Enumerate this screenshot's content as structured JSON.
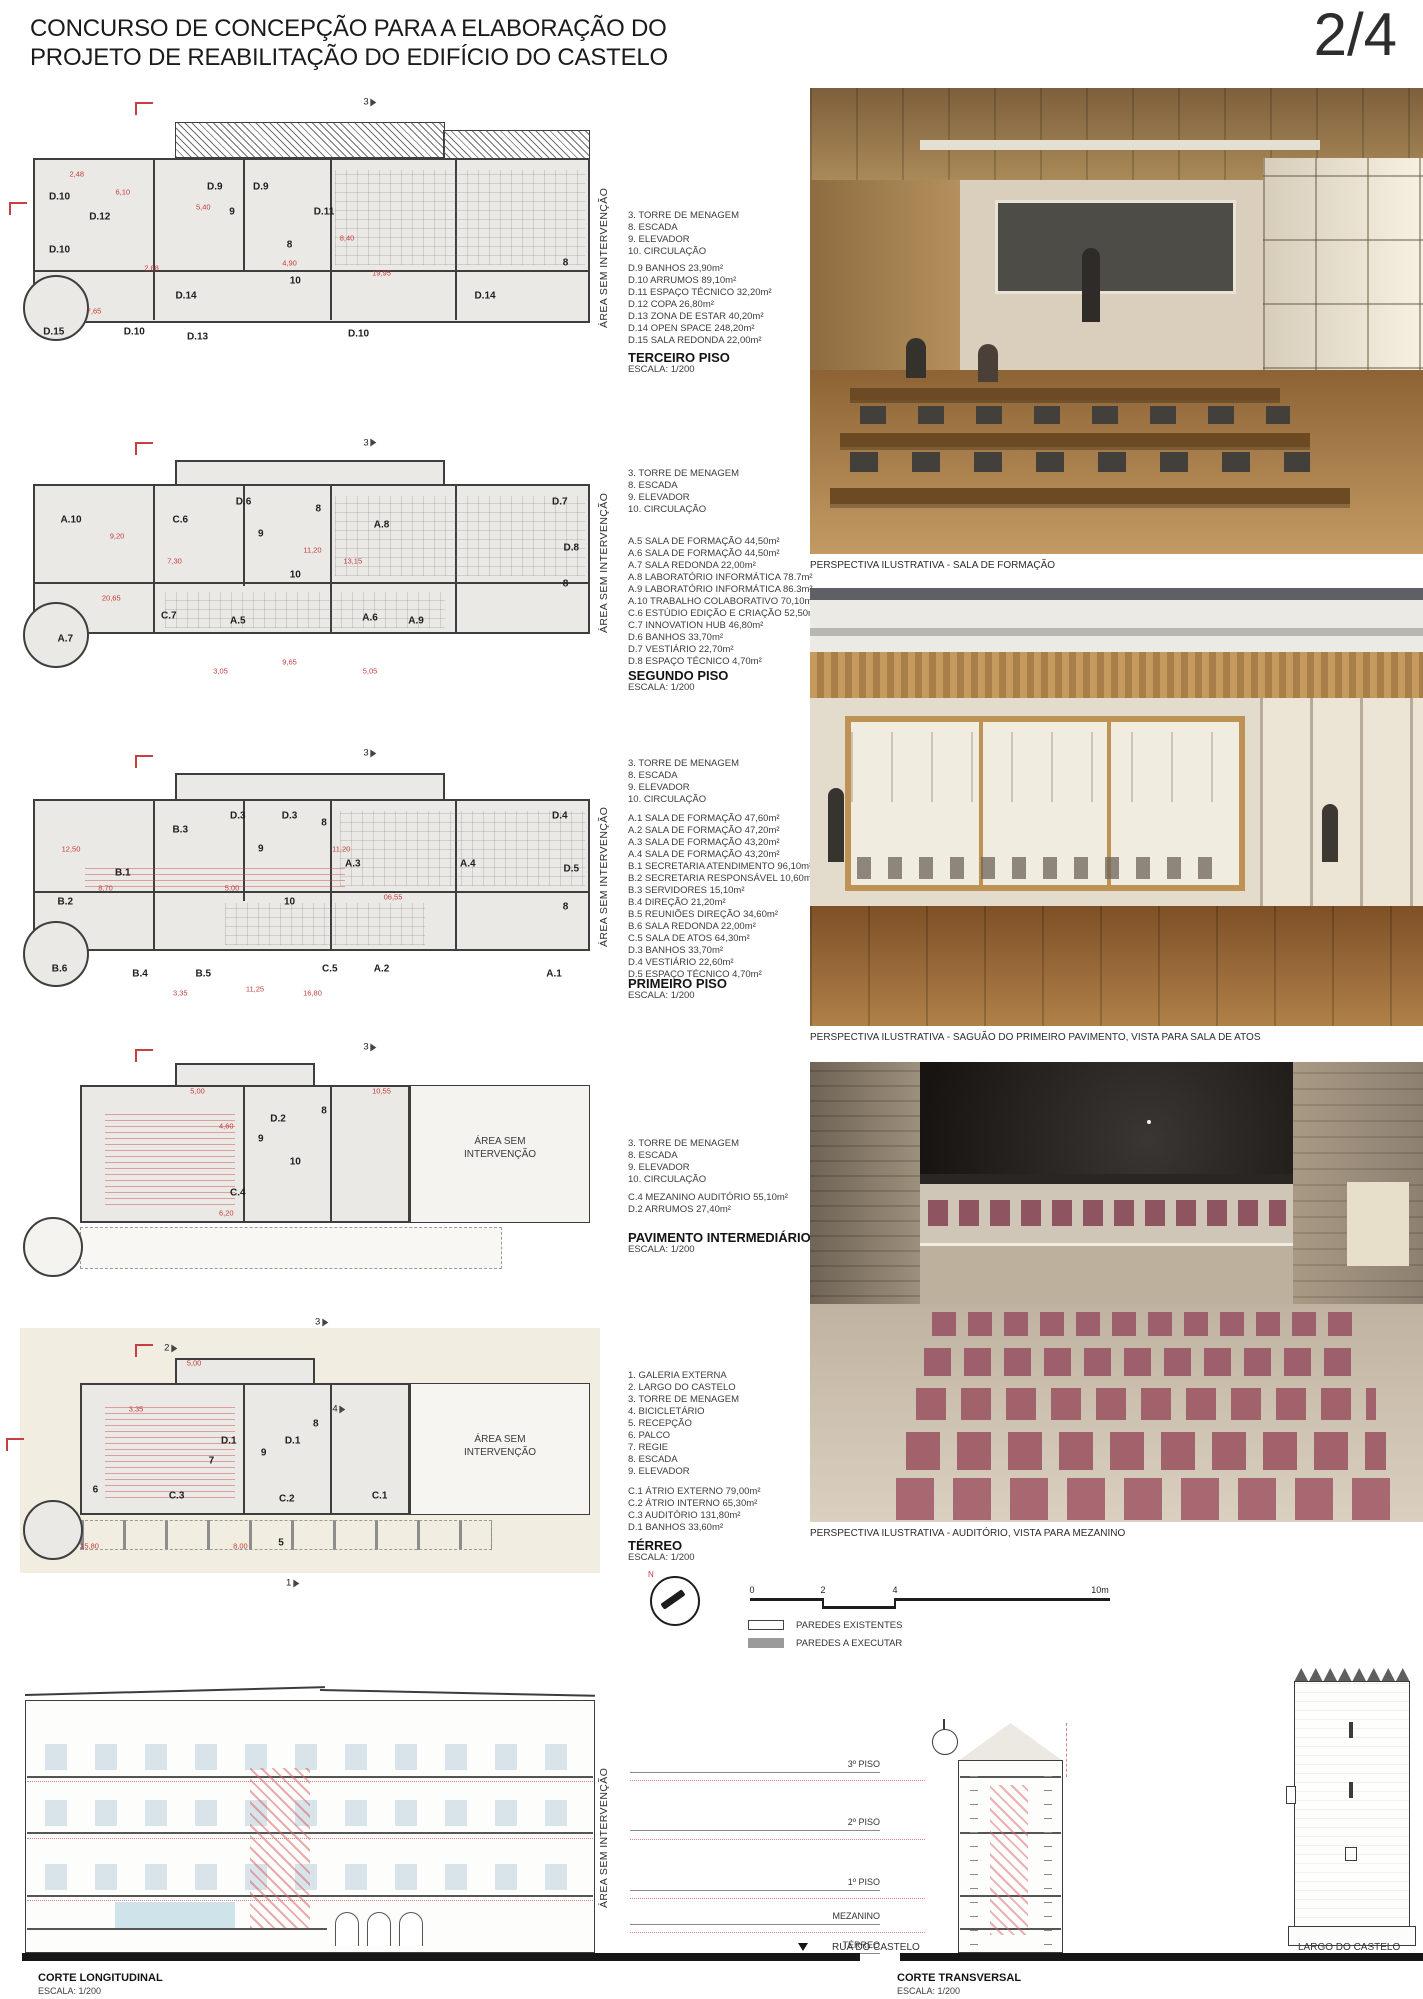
{
  "header": {
    "title_line1": "CONCURSO DE CONCEPÇÃO PARA A ELABORAÇÃO DO",
    "title_line2": "PROJETO DE REABILITAÇÃO DO EDIFÍCIO DO CASTELO",
    "page": "2/4"
  },
  "colors": {
    "accent_red": "#c43c3c",
    "plan_fill": "#eae9e5",
    "wall": "#3e3e3e",
    "chair_mauve": "#9c5f6b"
  },
  "plans": [
    {
      "title": "TERCEIRO PISO",
      "scale": "ESCALA: 1/200",
      "side_label": "ÁREA SEM INTERVENÇÃO",
      "key_items": [
        "3. TORRE DE MENAGEM",
        "8. ESCADA",
        "9. ELEVADOR",
        "10. CIRCULAÇÃO"
      ],
      "rooms": [
        "D.9 BANHOS 23,90m²",
        "D.10 ARRUMOS 89,10m²",
        "D.11 ESPAÇO TÉCNICO 32,20m²",
        "D.12 COPA 26,80m²",
        "D.13 ZONA DE ESTAR 40,20m²",
        "D.14 OPEN SPACE 248,20m²",
        "D.15 SALA REDONDA 22,00m²"
      ],
      "room_labels": [
        {
          "t": "3",
          "x": 60,
          "y": -3,
          "cls": "marker"
        },
        {
          "t": "D.12",
          "x": 13,
          "y": 42
        },
        {
          "t": "D.10",
          "x": 6,
          "y": 34
        },
        {
          "t": "D.10",
          "x": 6,
          "y": 55
        },
        {
          "t": "D.9",
          "x": 33,
          "y": 30
        },
        {
          "t": "D.9",
          "x": 41,
          "y": 30
        },
        {
          "t": "9",
          "x": 36,
          "y": 40
        },
        {
          "t": "D.11",
          "x": 52,
          "y": 40
        },
        {
          "t": "8",
          "x": 46,
          "y": 53
        },
        {
          "t": "10",
          "x": 47,
          "y": 67
        },
        {
          "t": "D.14",
          "x": 28,
          "y": 73
        },
        {
          "t": "D.14",
          "x": 80,
          "y": 73
        },
        {
          "t": "8",
          "x": 94,
          "y": 60
        },
        {
          "t": "D.10",
          "x": 19,
          "y": 87
        },
        {
          "t": "D.13",
          "x": 30,
          "y": 89
        },
        {
          "t": "D.10",
          "x": 58,
          "y": 88
        },
        {
          "t": "D.15",
          "x": 5,
          "y": 87
        },
        {
          "t": "2,48",
          "x": 9,
          "y": 25,
          "cls": "red"
        },
        {
          "t": "6,10",
          "x": 17,
          "y": 32,
          "cls": "red"
        },
        {
          "t": "5,40",
          "x": 31,
          "y": 38,
          "cls": "red"
        },
        {
          "t": "8,40",
          "x": 56,
          "y": 50,
          "cls": "red"
        },
        {
          "t": "19,95",
          "x": 62,
          "y": 64,
          "cls": "red"
        },
        {
          "t": "4,90",
          "x": 46,
          "y": 60,
          "cls": "red"
        },
        {
          "t": "2,68",
          "x": 22,
          "y": 62,
          "cls": "red"
        },
        {
          "t": "7,65",
          "x": 12,
          "y": 79,
          "cls": "red"
        }
      ]
    },
    {
      "title": "SEGUNDO PISO",
      "scale": "ESCALA: 1/200",
      "side_label": "ÁREA SEM INTERVENÇÃO",
      "key_items": [
        "3. TORRE DE MENAGEM",
        "8. ESCADA",
        "9. ELEVADOR",
        "10. CIRCULAÇÃO"
      ],
      "rooms": [
        "A.5 SALA DE FORMAÇÃO 44,50m²",
        "A.6 SALA DE FORMAÇÃO 44,50m²",
        "A.7 SALA REDONDA 22,00m²",
        "A.8 LABORATÓRIO INFORMÁTICA 78.7m²",
        "A.9 LABORATÓRIO INFORMÁTICA 86.3m²",
        "A.10 TRABALHO COLABORATIVO 70,10m²",
        "C.6 ESTÚDIO EDIÇÃO E CRIAÇÃO 52,50m²",
        "C.7 INNOVATION HUB 46,80m²",
        "D.6 BANHOS 33,70m²",
        "D.7 VESTIÁRIO 22,70m²",
        "D.8 ESPAÇO TÉCNICO 4,70m²"
      ],
      "room_labels": [
        {
          "t": "3",
          "x": 60,
          "y": -4,
          "cls": "marker"
        },
        {
          "t": "A.10",
          "x": 8,
          "y": 30
        },
        {
          "t": "C.6",
          "x": 27,
          "y": 30
        },
        {
          "t": "D.6",
          "x": 38,
          "y": 22
        },
        {
          "t": "9",
          "x": 41,
          "y": 36
        },
        {
          "t": "8",
          "x": 51,
          "y": 25
        },
        {
          "t": "A.8",
          "x": 62,
          "y": 32
        },
        {
          "t": "D.7",
          "x": 93,
          "y": 22
        },
        {
          "t": "D.8",
          "x": 95,
          "y": 42
        },
        {
          "t": "10",
          "x": 47,
          "y": 54
        },
        {
          "t": "A.7",
          "x": 7,
          "y": 82
        },
        {
          "t": "C.7",
          "x": 25,
          "y": 72
        },
        {
          "t": "A.5",
          "x": 37,
          "y": 74
        },
        {
          "t": "A.6",
          "x": 60,
          "y": 73
        },
        {
          "t": "A.9",
          "x": 68,
          "y": 74
        },
        {
          "t": "8",
          "x": 94,
          "y": 58
        },
        {
          "t": "9,20",
          "x": 16,
          "y": 37,
          "cls": "red"
        },
        {
          "t": "7,30",
          "x": 26,
          "y": 48,
          "cls": "red"
        },
        {
          "t": "13,15",
          "x": 57,
          "y": 48,
          "cls": "red"
        },
        {
          "t": "11,20",
          "x": 50,
          "y": 43,
          "cls": "red"
        },
        {
          "t": "20,65",
          "x": 15,
          "y": 64,
          "cls": "red"
        },
        {
          "t": "9,65",
          "x": 46,
          "y": 92,
          "cls": "red"
        },
        {
          "t": "3,05",
          "x": 34,
          "y": 96,
          "cls": "red"
        },
        {
          "t": "5,05",
          "x": 60,
          "y": 96,
          "cls": "red"
        }
      ]
    },
    {
      "title": "PRIMEIRO PISO",
      "scale": "ESCALA: 1/200",
      "side_label": "ÁREA SEM INTERVENÇÃO",
      "key_items": [
        "3. TORRE DE MENAGEM",
        "8. ESCADA",
        "9. ELEVADOR",
        "10. CIRCULAÇÃO"
      ],
      "rooms": [
        "A.1 SALA DE FORMAÇÃO 47,60m²",
        "A.2 SALA DE FORMAÇÃO 47,20m²",
        "A.3 SALA DE FORMAÇÃO 43,20m²",
        "A.4 SALA DE FORMAÇÃO 43,20m²",
        "B.1 SECRETARIA ATENDIMENTO 96,10m²",
        "B.2 SECRETARIA RESPONSÁVEL 10,60m²",
        "B.3 SERVIDORES 15,10m²",
        "B.4 DIREÇÃO 21,20m²",
        "B.5 REUNIÕES DIREÇÃO 34,60m²",
        "B.6 SALA REDONDA 22,00m²",
        "C.5 SALA DE ATOS 64,30m²",
        "D.3 BANHOS 33,70m²",
        "D.4 VESTIÁRIO 22,60m²",
        "D.5 ESPAÇO TÉCNICO 4,70m²"
      ],
      "room_labels": [
        {
          "t": "3",
          "x": 60,
          "y": -4,
          "cls": "marker"
        },
        {
          "t": "B.3",
          "x": 27,
          "y": 28
        },
        {
          "t": "D.3",
          "x": 37,
          "y": 22
        },
        {
          "t": "D.3",
          "x": 46,
          "y": 22
        },
        {
          "t": "B.1",
          "x": 17,
          "y": 46
        },
        {
          "t": "B.2",
          "x": 7,
          "y": 58
        },
        {
          "t": "A.3",
          "x": 57,
          "y": 42
        },
        {
          "t": "A.4",
          "x": 77,
          "y": 42
        },
        {
          "t": "D.4",
          "x": 93,
          "y": 22
        },
        {
          "t": "D.5",
          "x": 95,
          "y": 44
        },
        {
          "t": "9",
          "x": 41,
          "y": 36
        },
        {
          "t": "8",
          "x": 52,
          "y": 25
        },
        {
          "t": "10",
          "x": 46,
          "y": 58
        },
        {
          "t": "8",
          "x": 94,
          "y": 60
        },
        {
          "t": "B.6",
          "x": 6,
          "y": 86
        },
        {
          "t": "B.4",
          "x": 20,
          "y": 88
        },
        {
          "t": "B.5",
          "x": 31,
          "y": 88
        },
        {
          "t": "C.5",
          "x": 53,
          "y": 86
        },
        {
          "t": "A.2",
          "x": 62,
          "y": 86
        },
        {
          "t": "A.1",
          "x": 92,
          "y": 88
        },
        {
          "t": "12,50",
          "x": 8,
          "y": 36,
          "cls": "red"
        },
        {
          "t": "8,70",
          "x": 14,
          "y": 52,
          "cls": "red"
        },
        {
          "t": "11,20",
          "x": 55,
          "y": 36,
          "cls": "red"
        },
        {
          "t": "06,55",
          "x": 64,
          "y": 56,
          "cls": "red"
        },
        {
          "t": "5,00",
          "x": 36,
          "y": 52,
          "cls": "red"
        },
        {
          "t": "11,25",
          "x": 40,
          "y": 94,
          "cls": "red"
        },
        {
          "t": "16,80",
          "x": 50,
          "y": 96,
          "cls": "red"
        },
        {
          "t": "3,35",
          "x": 27,
          "y": 96,
          "cls": "red"
        }
      ]
    },
    {
      "title": "PAVIMENTO INTERMEDIÁRIO",
      "scale": "ESCALA: 1/200",
      "side_label": "",
      "inner_label_1": "ÁREA SEM",
      "inner_label_2": "INTERVENÇÃO",
      "key_items": [
        "3. TORRE DE MENAGEM",
        "8. ESCADA",
        "9. ELEVADOR",
        "10. CIRCULAÇÃO"
      ],
      "rooms": [
        "C.4 MEZANINO AUDITÓRIO 55,10m²",
        "D.2 ARRUMOS 27,40m²"
      ],
      "room_labels": [
        {
          "t": "3",
          "x": 60,
          "y": -3,
          "cls": "marker"
        },
        {
          "t": "D.2",
          "x": 44,
          "y": 25
        },
        {
          "t": "8",
          "x": 52,
          "y": 22
        },
        {
          "t": "9",
          "x": 41,
          "y": 33
        },
        {
          "t": "10",
          "x": 47,
          "y": 42
        },
        {
          "t": "C.4",
          "x": 37,
          "y": 54
        },
        {
          "t": "10,55",
          "x": 62,
          "y": 14,
          "cls": "red"
        },
        {
          "t": "4,60",
          "x": 35,
          "y": 28,
          "cls": "red"
        },
        {
          "t": "5,00",
          "x": 30,
          "y": 14,
          "cls": "red"
        },
        {
          "t": "6,20",
          "x": 35,
          "y": 62,
          "cls": "red"
        }
      ]
    },
    {
      "title": "TÉRREO",
      "scale": "ESCALA: 1/200",
      "side_label": "",
      "inner_label_1": "ÁREA SEM",
      "inner_label_2": "INTERVENÇÃO",
      "key_items": [
        "1. GALERIA EXTERNA",
        "2. LARGO DO CASTELO",
        "3. TORRE DE MENAGEM",
        "4. BICICLETÁRIO",
        "5. RECEPÇÃO",
        "6. PALCO",
        "7. REGIE",
        "8. ESCADA",
        "9. ELEVADOR"
      ],
      "rooms": [
        "C.1 ÁTRIO EXTERNO 79,00m²",
        "C.2 ÁTRIO INTERNO 65,30m²",
        "C.3 AUDITÓRIO 131,80m²",
        "D.1 BANHOS 33,60m²"
      ],
      "room_labels": [
        {
          "t": "3",
          "x": 52,
          "y": -2,
          "cls": "marker"
        },
        {
          "t": "2",
          "x": 26,
          "y": 7,
          "cls": "marker"
        },
        {
          "t": "D.1",
          "x": 36,
          "y": 39
        },
        {
          "t": "D.1",
          "x": 47,
          "y": 39
        },
        {
          "t": "9",
          "x": 42,
          "y": 43
        },
        {
          "t": "8",
          "x": 51,
          "y": 33
        },
        {
          "t": "7",
          "x": 33,
          "y": 46
        },
        {
          "t": "4",
          "x": 55,
          "y": 28,
          "cls": "marker"
        },
        {
          "t": "6",
          "x": 13,
          "y": 56
        },
        {
          "t": "C.3",
          "x": 27,
          "y": 58
        },
        {
          "t": "C.2",
          "x": 46,
          "y": 59
        },
        {
          "t": "C.1",
          "x": 62,
          "y": 58
        },
        {
          "t": "5",
          "x": 45,
          "y": 74
        },
        {
          "t": "1",
          "x": 47,
          "y": 88,
          "cls": "marker"
        },
        {
          "t": "15,80",
          "x": 12,
          "y": 75,
          "cls": "red"
        },
        {
          "t": "8,00",
          "x": 38,
          "y": 75,
          "cls": "red"
        },
        {
          "t": "5,00",
          "x": 30,
          "y": 12,
          "cls": "red"
        },
        {
          "t": "3,35",
          "x": 20,
          "y": 28,
          "cls": "red"
        }
      ]
    }
  ],
  "renders": [
    {
      "caption": "PERSPECTIVA ILUSTRATIVA - SALA DE FORMAÇÃO"
    },
    {
      "caption": "PERSPECTIVA ILUSTRATIVA - SAGUÃO DO PRIMEIRO PAVIMENTO, VISTA PARA SALA DE ATOS"
    },
    {
      "caption": "PERSPECTIVA ILUSTRATIVA - AUDITÓRIO, VISTA PARA MEZANINO"
    }
  ],
  "scalebar": {
    "ticks": [
      "0",
      "2",
      "4",
      "10m"
    ],
    "wall_key": [
      "PAREDES EXISTENTES",
      "PAREDES A EXECUTAR"
    ]
  },
  "sections": {
    "longitudinal": {
      "title": "CORTE LONGITUDINAL",
      "scale": "ESCALA: 1/200",
      "side_label": "ÁREA SEM INTERVENÇÃO"
    },
    "transversal": {
      "title": "CORTE TRANSVERSAL",
      "scale": "ESCALA: 1/200"
    },
    "levels": [
      "3º PISO",
      "2º PISO",
      "1º PISO",
      "MEZANINO",
      "TÉRREO"
    ],
    "street_left": "RUA DO CASTELO",
    "street_right": "LARGO DO CASTELO"
  }
}
